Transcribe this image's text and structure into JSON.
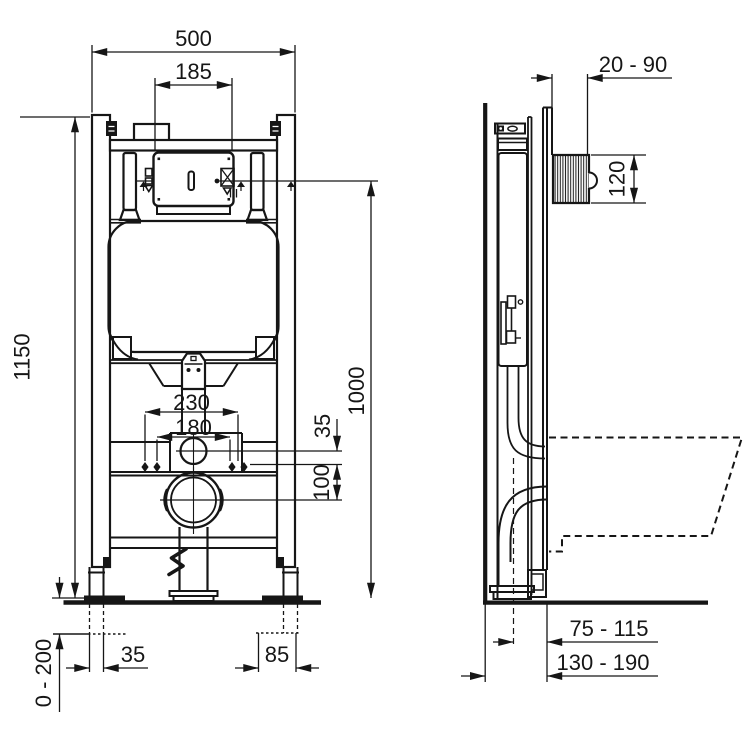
{
  "drawing": {
    "front_view": {
      "dim_overall_width": "500",
      "dim_cistern_width": "185",
      "dim_total_height": "1150",
      "dim_actuation_height": "1000",
      "dim_fixing_outer": "230",
      "dim_fixing_inner": "180",
      "dim_inlet_offset": "35",
      "dim_outlet_offset": "100",
      "dim_foot_slot": "35",
      "dim_foot_span": "85",
      "dim_floor_adjust": "0 - 200"
    },
    "side_view": {
      "dim_wall_offset": "20 - 90",
      "dim_plate_recess": "120",
      "dim_outlet_depth": "75 - 115",
      "dim_frame_depth": "130 - 190"
    },
    "colors": {
      "line": "#161616",
      "background": "#ffffff"
    }
  }
}
